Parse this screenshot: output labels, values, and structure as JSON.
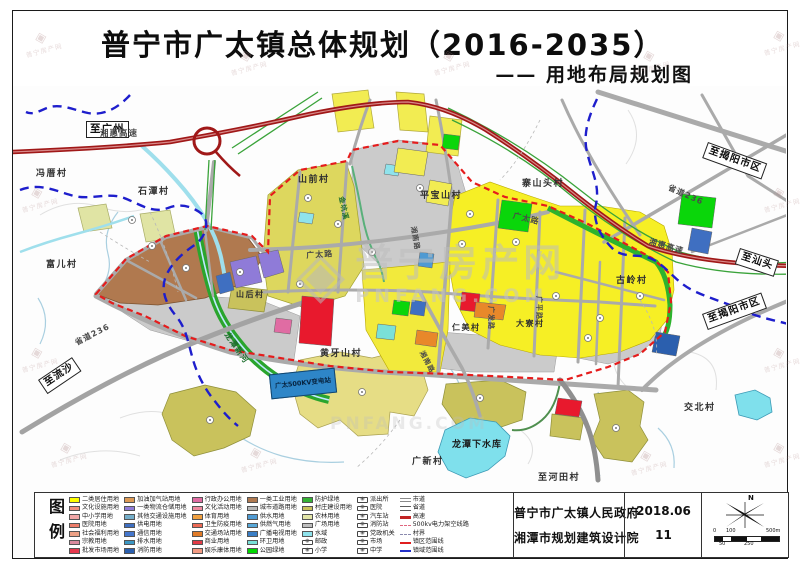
{
  "title": {
    "main": "普宁市广太镇总体规划（2016-2035）",
    "subtitle": "—— 用地布局规划图"
  },
  "legend": {
    "heading": "图例",
    "columns": [
      {
        "items": [
          {
            "label": "二类居住用地",
            "sym": "swatch",
            "color": "#ffff00"
          },
          {
            "label": "文化设施用地",
            "sym": "swatch",
            "color": "#f0907e"
          },
          {
            "label": "中小学用地",
            "sym": "swatch",
            "color": "#f2a8a8"
          },
          {
            "label": "医院用地",
            "sym": "swatch",
            "color": "#ed7d6a"
          },
          {
            "label": "社会福利用地",
            "sym": "swatch",
            "color": "#eda186"
          },
          {
            "label": "宗教用地",
            "sym": "swatch",
            "color": "#d98a9e"
          },
          {
            "label": "批发市场用地",
            "sym": "swatch",
            "color": "#e7394e"
          }
        ]
      },
      {
        "items": [
          {
            "label": "加油加气站用地",
            "sym": "swatch",
            "color": "#dd9a55"
          },
          {
            "label": "一类物流仓储用地",
            "sym": "swatch",
            "color": "#8f7bd8"
          },
          {
            "label": "其他交通设施用地",
            "sym": "swatch",
            "color": "#74aec9"
          },
          {
            "label": "供电用地",
            "sym": "swatch",
            "color": "#3f6fc1"
          },
          {
            "label": "通信用地",
            "sym": "swatch",
            "color": "#4577cd"
          },
          {
            "label": "排水用地",
            "sym": "swatch",
            "color": "#3b97c4"
          },
          {
            "label": "消防用地",
            "sym": "swatch",
            "color": "#2b5fae"
          }
        ]
      },
      {
        "items": [
          {
            "label": "行政办公用地",
            "sym": "swatch",
            "color": "#e06ca3"
          },
          {
            "label": "文化活动用地",
            "sym": "swatch",
            "color": "#ef8aa0"
          },
          {
            "label": "体育用地",
            "sym": "swatch",
            "color": "#f0a040"
          },
          {
            "label": "卫生防疫用地",
            "sym": "swatch",
            "color": "#ec6a55"
          },
          {
            "label": "交通场站用地",
            "sym": "swatch",
            "color": "#e07b28"
          },
          {
            "label": "商业用地",
            "sym": "swatch",
            "color": "#e23a46"
          },
          {
            "label": "娱乐康体用地",
            "sym": "swatch",
            "color": "#f29a82"
          }
        ]
      },
      {
        "items": [
          {
            "label": "一类工业用地",
            "sym": "swatch",
            "color": "#b07a50"
          },
          {
            "label": "城市道路用地",
            "sym": "swatch",
            "color": "#b8b8b8"
          },
          {
            "label": "供水用地",
            "sym": "swatch",
            "color": "#4f9ad2"
          },
          {
            "label": "供燃气用地",
            "sym": "swatch",
            "color": "#58a8d8"
          },
          {
            "label": "广播电视用地",
            "sym": "swatch",
            "color": "#3a7ec5"
          },
          {
            "label": "环卫用地",
            "sym": "swatch",
            "color": "#7ae0d8"
          },
          {
            "label": "公园绿地",
            "sym": "swatch",
            "color": "#00d800"
          }
        ]
      },
      {
        "items": [
          {
            "label": "防护绿地",
            "sym": "swatch",
            "color": "#35b235"
          },
          {
            "label": "村庄建设用地",
            "sym": "swatch",
            "color": "#c9c25c"
          },
          {
            "label": "农林用地",
            "sym": "swatch",
            "color": "#e3e6a8"
          },
          {
            "label": "广场用地",
            "sym": "swatch",
            "color": "#bfbfbf"
          },
          {
            "label": "水域",
            "sym": "swatch",
            "color": "#8fe3ec"
          },
          {
            "label": "邮政",
            "sym": "icon"
          },
          {
            "label": "小学",
            "sym": "icon"
          }
        ]
      },
      {
        "items": [
          {
            "label": "派出所",
            "sym": "icon"
          },
          {
            "label": "医院",
            "sym": "icon"
          },
          {
            "label": "汽车站",
            "sym": "icon"
          },
          {
            "label": "消防站",
            "sym": "icon"
          },
          {
            "label": "党政机关",
            "sym": "icon"
          },
          {
            "label": "市场",
            "sym": "icon"
          },
          {
            "label": "中学",
            "sym": "icon"
          }
        ]
      },
      {
        "items": [
          {
            "label": "市道",
            "sym": "road-minor"
          },
          {
            "label": "省道",
            "sym": "road-prov"
          },
          {
            "label": "高速",
            "sym": "road-hwy"
          },
          {
            "label": "500kv电力架空线路",
            "sym": "power-line"
          },
          {
            "label": "村界",
            "sym": "village-border"
          },
          {
            "label": "镇区范围线",
            "sym": "town-line"
          },
          {
            "label": "镇域范围线",
            "sym": "domain-line"
          }
        ]
      }
    ]
  },
  "footer": {
    "agency_line1": "普宁市广太镇人民政府",
    "agency_line2": "湘潭市规划建筑设计院",
    "date": "2018.06",
    "sheet_no": "11",
    "north_label": "N",
    "scale_top": [
      "0",
      "100",
      "500m"
    ],
    "scale_bottom": [
      "50",
      "250"
    ]
  },
  "map": {
    "substation_label": "广太500KV变电站",
    "labels": [
      {
        "text": "至广州",
        "x": 86,
        "y": 121,
        "s": 10.5,
        "cls": "boxed"
      },
      {
        "text": "湘惠高速",
        "x": 100,
        "y": 130,
        "s": 8.5,
        "cls": "road"
      },
      {
        "text": "冯厝村",
        "x": 36,
        "y": 170,
        "s": 9,
        "cls": "village"
      },
      {
        "text": "石潭村",
        "x": 138,
        "y": 188,
        "s": 9,
        "cls": "village"
      },
      {
        "text": "山前村",
        "x": 298,
        "y": 176,
        "s": 9,
        "cls": "village"
      },
      {
        "text": "平宝山村",
        "x": 420,
        "y": 192,
        "s": 9,
        "cls": "village"
      },
      {
        "text": "寨山头村",
        "x": 522,
        "y": 180,
        "s": 9,
        "cls": "village"
      },
      {
        "text": "富儿村",
        "x": 46,
        "y": 261,
        "s": 9,
        "cls": "village"
      },
      {
        "text": "山后村",
        "x": 236,
        "y": 291,
        "s": 8,
        "cls": "village"
      },
      {
        "text": "广太路",
        "x": 306,
        "y": 252,
        "s": 8,
        "rot": -4,
        "cls": "road"
      },
      {
        "text": "广太路",
        "x": 514,
        "y": 212,
        "s": 8,
        "rot": 14,
        "cls": "road"
      },
      {
        "text": "湘惠高速",
        "x": 650,
        "y": 238,
        "s": 8,
        "rot": 16,
        "cls": "road"
      },
      {
        "text": "至汕头",
        "x": 740,
        "y": 248,
        "s": 10,
        "rot": 18,
        "cls": "boxed"
      },
      {
        "text": "省道236",
        "x": 670,
        "y": 184,
        "s": 8,
        "rot": 24,
        "cls": "road"
      },
      {
        "text": "至揭阳市区",
        "x": 708,
        "y": 142,
        "s": 10,
        "rot": 20,
        "cls": "boxed"
      },
      {
        "text": "至揭阳市区",
        "x": 702,
        "y": 314,
        "s": 10,
        "rot": -20,
        "cls": "boxed"
      },
      {
        "text": "古岭村",
        "x": 616,
        "y": 277,
        "s": 9,
        "cls": "village"
      },
      {
        "text": "大寮村",
        "x": 516,
        "y": 320,
        "s": 8,
        "cls": "village"
      },
      {
        "text": "仁美村",
        "x": 452,
        "y": 324,
        "s": 8,
        "cls": "village"
      },
      {
        "text": "广发路",
        "x": 494,
        "y": 306,
        "s": 7,
        "rot": 90,
        "cls": "road"
      },
      {
        "text": "广平路",
        "x": 542,
        "y": 296,
        "s": 7,
        "rot": 90,
        "cls": "road"
      },
      {
        "text": "湘南路",
        "x": 424,
        "y": 350,
        "s": 7,
        "rot": 62,
        "cls": "road"
      },
      {
        "text": "湘南路",
        "x": 416,
        "y": 226,
        "s": 7,
        "rot": 80,
        "cls": "road"
      },
      {
        "text": "黄牙山村",
        "x": 320,
        "y": 350,
        "s": 9,
        "cls": "village"
      },
      {
        "text": "龙潭新河",
        "x": 229,
        "y": 331,
        "s": 8,
        "rot": 55,
        "cls": "stream"
      },
      {
        "text": "省道236",
        "x": 74,
        "y": 340,
        "s": 8,
        "rot": -27,
        "cls": "road"
      },
      {
        "text": "至流沙",
        "x": 38,
        "y": 380,
        "s": 10,
        "rot": -34,
        "cls": "boxed"
      },
      {
        "text": "金坑溪",
        "x": 344,
        "y": 196,
        "s": 7,
        "rot": 78,
        "cls": "stream"
      },
      {
        "text": "龙潭下水库",
        "x": 452,
        "y": 441,
        "s": 9,
        "cls": "water"
      },
      {
        "text": "广新村",
        "x": 412,
        "y": 458,
        "s": 9,
        "cls": "village"
      },
      {
        "text": "交北村",
        "x": 684,
        "y": 404,
        "s": 9,
        "cls": "village"
      },
      {
        "text": "至河田村",
        "x": 538,
        "y": 474,
        "s": 9,
        "cls": "village"
      }
    ]
  },
  "watermark": {
    "logo_glyph": "◈",
    "name": "普宁房产网",
    "domain": "PNFANG.COM"
  }
}
